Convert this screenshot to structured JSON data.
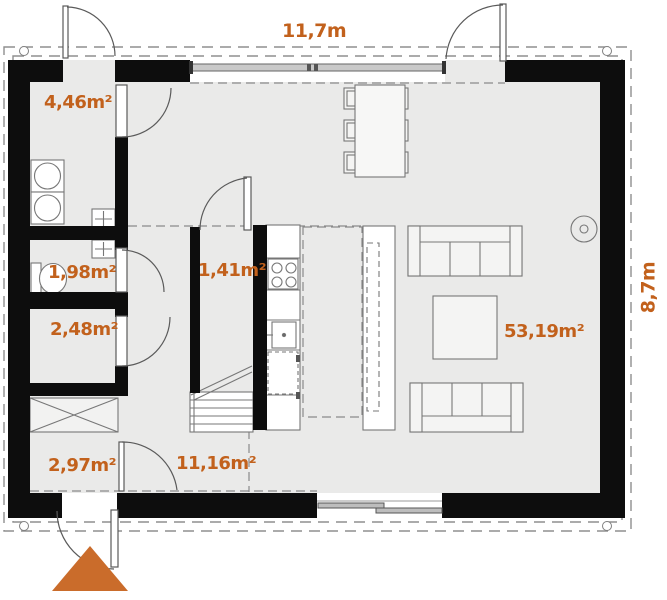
{
  "title": "house floor plan",
  "dimensions": {
    "width_label": "11,7m",
    "height_label": "8,7m"
  },
  "rooms": {
    "utility": {
      "area": "4,46m²"
    },
    "wc": {
      "area": "1,98m²"
    },
    "storage": {
      "area": "2,48m²"
    },
    "pantry": {
      "area": "1,41m²"
    },
    "entry": {
      "area": "2,97m²"
    },
    "hall": {
      "area": "11,16m²"
    },
    "living": {
      "area": "53,19m²"
    }
  },
  "colors": {
    "accent": "#c2611c",
    "entrance_arrow": "#ca6c2b",
    "wall": "#0d0d0d",
    "floor": "#eaeae9",
    "line": "#6e6e6e"
  },
  "symbols": [
    "entrance-arrow-icon",
    "door-swing",
    "window",
    "sliding-door",
    "dining-table",
    "dining-chair",
    "sofa",
    "coffee-table",
    "kitchen-island",
    "kitchen-counter",
    "stove",
    "sink",
    "dishwasher",
    "stairs",
    "washing-machine",
    "toilet",
    "wardrobe",
    "vent-chimney",
    "wood-stove",
    "roof-outline"
  ]
}
